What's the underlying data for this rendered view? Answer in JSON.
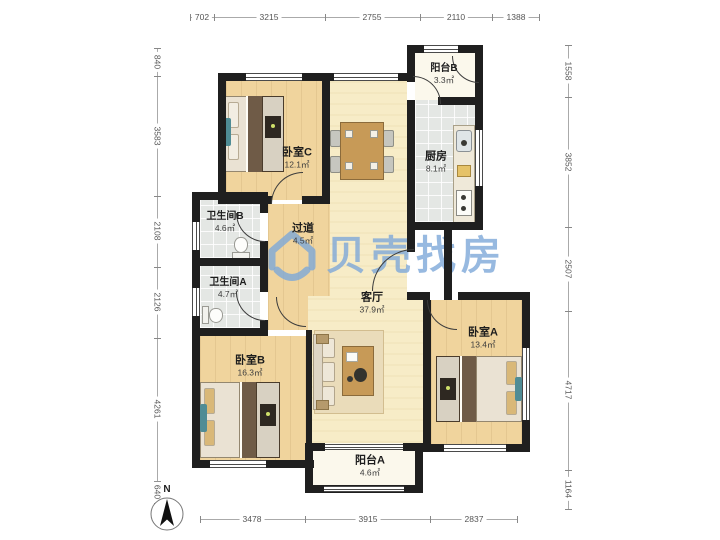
{
  "watermark": {
    "text": "贝壳找房",
    "logo": "beike-house-logo"
  },
  "north": {
    "label": "N"
  },
  "rooms": {
    "bedroom_c": {
      "name": "卧室C",
      "area": "12.1㎡"
    },
    "balcony_b": {
      "name": "阳台B",
      "area": "3.3㎡"
    },
    "kitchen": {
      "name": "厨房",
      "area": "8.1㎡"
    },
    "bath_b": {
      "name": "卫生间B",
      "area": "4.6㎡"
    },
    "hallway": {
      "name": "过道",
      "area": "4.5㎡"
    },
    "bath_a": {
      "name": "卫生间A",
      "area": "4.7㎡"
    },
    "living": {
      "name": "客厅",
      "area": "37.9㎡"
    },
    "bedroom_a": {
      "name": "卧室A",
      "area": "13.4㎡"
    },
    "bedroom_b": {
      "name": "卧室B",
      "area": "16.3㎡"
    },
    "balcony_a": {
      "name": "阳台A",
      "area": "4.6㎡"
    }
  },
  "dimensions": {
    "top": [
      "702",
      "3215",
      "2755",
      "2110",
      "1388"
    ],
    "left": [
      "840",
      "3583",
      "2108",
      "2126",
      "4261",
      "640"
    ],
    "right": [
      "1558",
      "3852",
      "2507",
      "4717",
      "1164"
    ],
    "bottom": [
      "3478",
      "3915",
      "2837"
    ]
  },
  "colors": {
    "wall": "#1f1f1f",
    "wood": "#f0d49d",
    "cream": "#f7ecc7",
    "tile": "#e4e7e4",
    "balcony": "#fbf8ec",
    "accent": "#4f8c95",
    "wm": "rgba(125,168,216,0.8)"
  }
}
